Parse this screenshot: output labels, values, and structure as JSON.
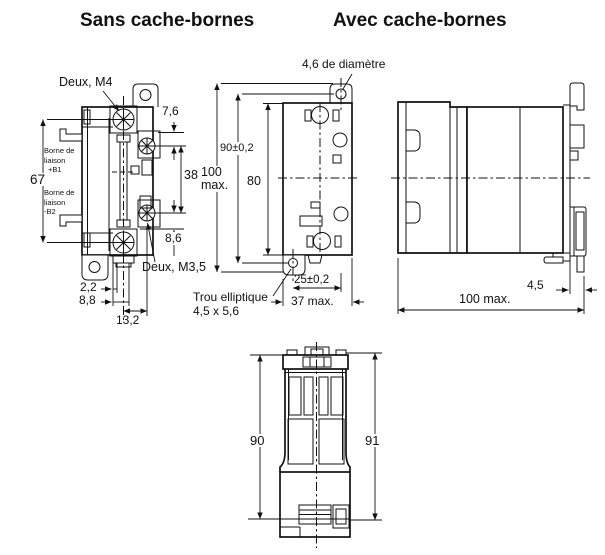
{
  "titles": {
    "without_covers": "Sans cache-bornes",
    "with_covers": "Avec cache-bornes"
  },
  "front_view": {
    "screw_top_callout": "Deux, M4",
    "screw_side_callout": "Deux, M3,5",
    "link_terminal_top": [
      "Borne de",
      "liaison",
      "+B1"
    ],
    "link_terminal_bottom": [
      "Borne de",
      "liaison",
      "-B2"
    ],
    "dims": {
      "terminal_span": "67",
      "top_gap": "7,6",
      "screw_spacing": "38",
      "bottom_gap": "8,6",
      "w1": "2,2",
      "w2": "8,8",
      "w3": "13,2"
    }
  },
  "mounting_view": {
    "hole_callout": "4,6 de diamètre",
    "slot_callout": [
      "Trou elliptique",
      "4,5 x 5,6"
    ],
    "dims": {
      "hole_spacing": "90±0,2",
      "overall_height": [
        "100",
        "max."
      ],
      "body_height": "80",
      "hole_offset": "25±0,2",
      "overall_width": "37 max."
    }
  },
  "side_view": {
    "dims": {
      "rail_clearance": "4,5",
      "overall_depth": "100 max."
    }
  },
  "cover_view": {
    "dims": {
      "height_left": "90",
      "height_right": "91"
    }
  }
}
